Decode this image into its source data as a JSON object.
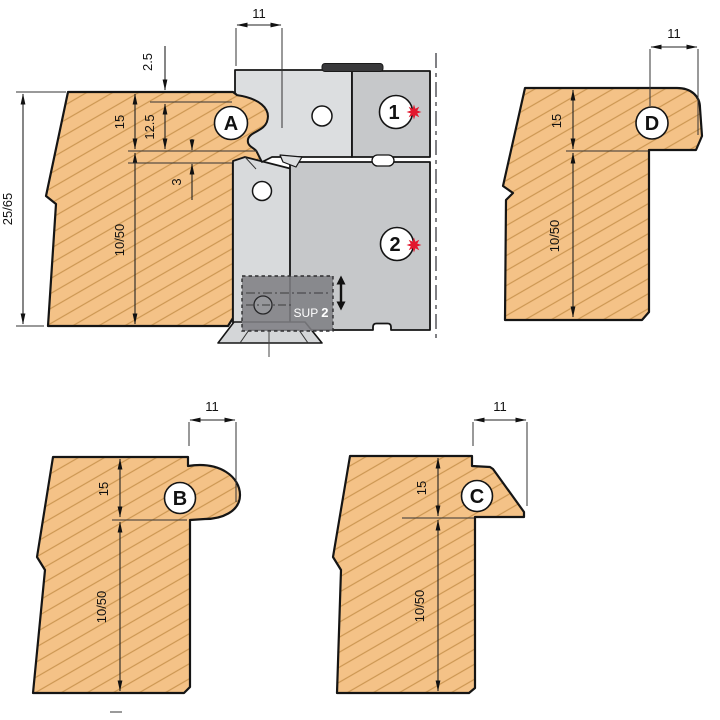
{
  "title": "Profile cutter head technical drawing",
  "palette": {
    "wood": "#f4c287",
    "grain": "#cc9752",
    "steel_light": "#dcdee0",
    "steel_mid": "#c6c8ca",
    "steel_plate": "#d8dadc",
    "bar_dark": "#39393b",
    "accent_red": "#e2182e",
    "sup_box": "#7f8084",
    "outline": "#151515"
  },
  "assembly": {
    "knife_marker": "1",
    "counter_knife_marker": "2",
    "sup_label": "SUP",
    "sup_number": "2",
    "profile_width": "11",
    "offset_top": "2.5",
    "profile_depth": "12.5",
    "step_depth": "3"
  },
  "pieces": {
    "main": {
      "label": "A",
      "thickness_range": "25/65",
      "profile_height": "15",
      "body_height": "10/50"
    },
    "b": {
      "label": "B",
      "profile_width": "11",
      "profile_height": "15",
      "body_height": "10/50"
    },
    "c": {
      "label": "C",
      "profile_width": "11",
      "profile_height": "15",
      "body_height": "10/50"
    },
    "d": {
      "label": "D",
      "profile_width": "11",
      "profile_height": "15",
      "body_height": "10/50"
    }
  }
}
